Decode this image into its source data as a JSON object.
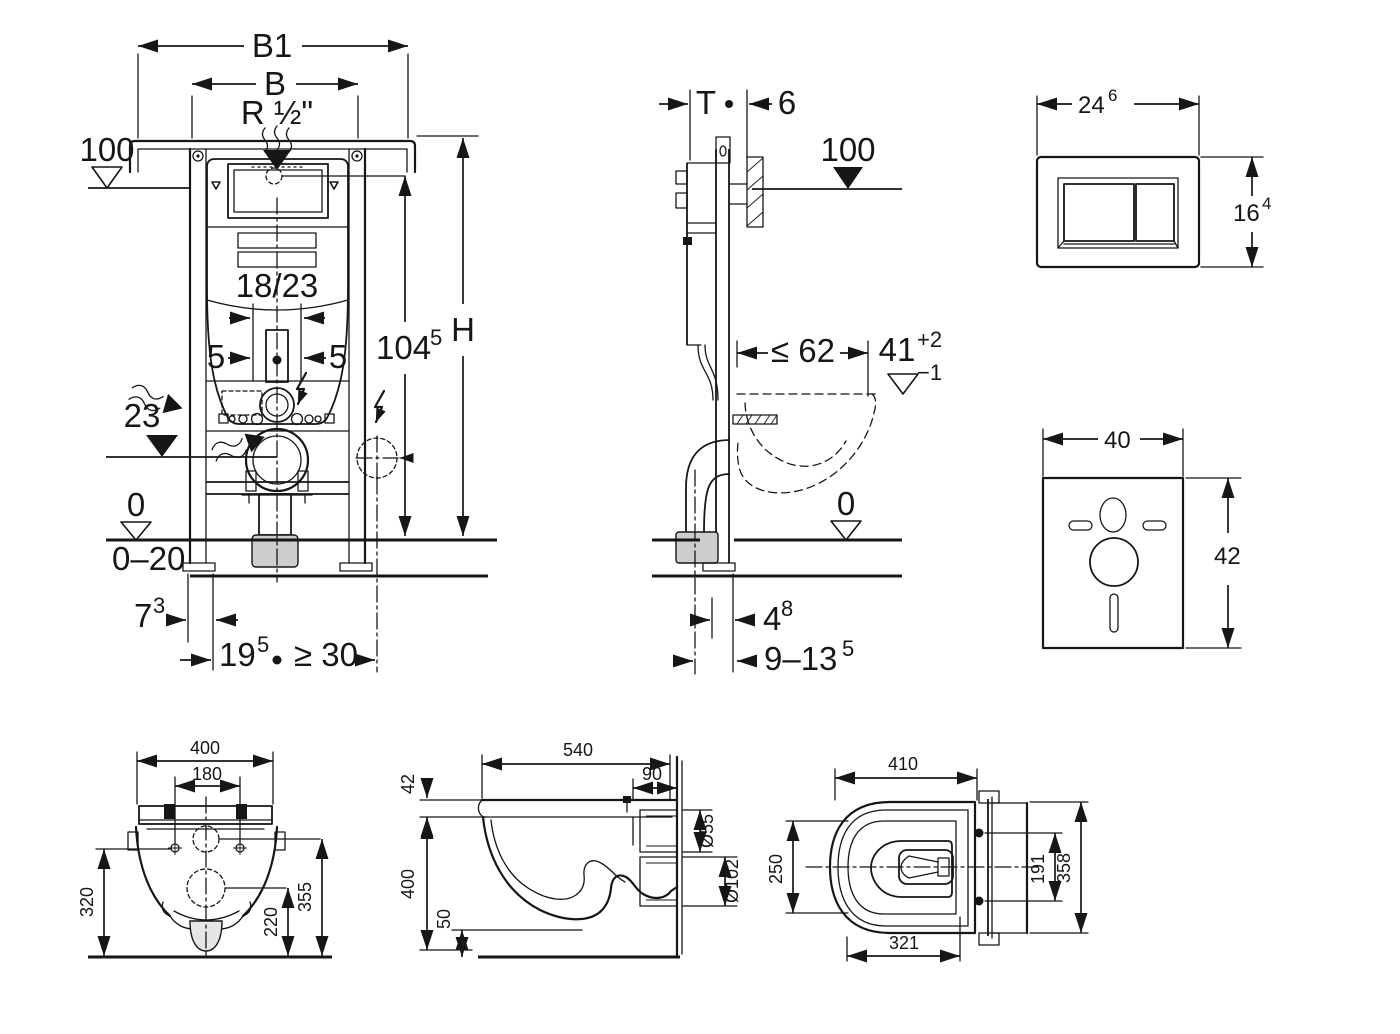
{
  "drawing": {
    "frame_front": {
      "b1": "B1",
      "b": "B",
      "water_conn": "R ½\"",
      "level": "100",
      "bracket": "18/23",
      "off_l": "5",
      "off_r": "5",
      "drain_h": "23",
      "conn_h": "104",
      "conn_h_sup": "5",
      "height": "H",
      "floor": "0",
      "floor_range": "0–20",
      "foot_off": "7",
      "foot_off_sup": "3",
      "anchor_off": "19",
      "anchor_off_sup": "5",
      "clearance": "≥ 30"
    },
    "frame_side": {
      "depth": "T",
      "gap": "6",
      "level": "100",
      "max_off": "≤ 62",
      "rim_h": "41",
      "rim_tol_up": "+2",
      "rim_tol_dn": "−1",
      "floor": "0",
      "drain_off": "4",
      "drain_off_sup": "8",
      "pipe_range": "9–13",
      "pipe_range_sup": "5"
    },
    "flush_plate": {
      "width": "24",
      "width_sup": "6",
      "height": "16",
      "height_sup": "4"
    },
    "sound_pad": {
      "width": "40",
      "height": "42"
    },
    "wc_rear": {
      "width": "400",
      "bolts": "180",
      "h_left": "320",
      "h_mid": "220",
      "h_right": "355"
    },
    "wc_side": {
      "depth": "540",
      "seat": "42",
      "back": "90",
      "flush_d": "Ø55",
      "drain_d": "Ø102",
      "height": "400",
      "gap": "50"
    },
    "wc_plan": {
      "depth": "410",
      "width": "250",
      "bolts": "191",
      "height": "358",
      "inner": "321"
    }
  }
}
